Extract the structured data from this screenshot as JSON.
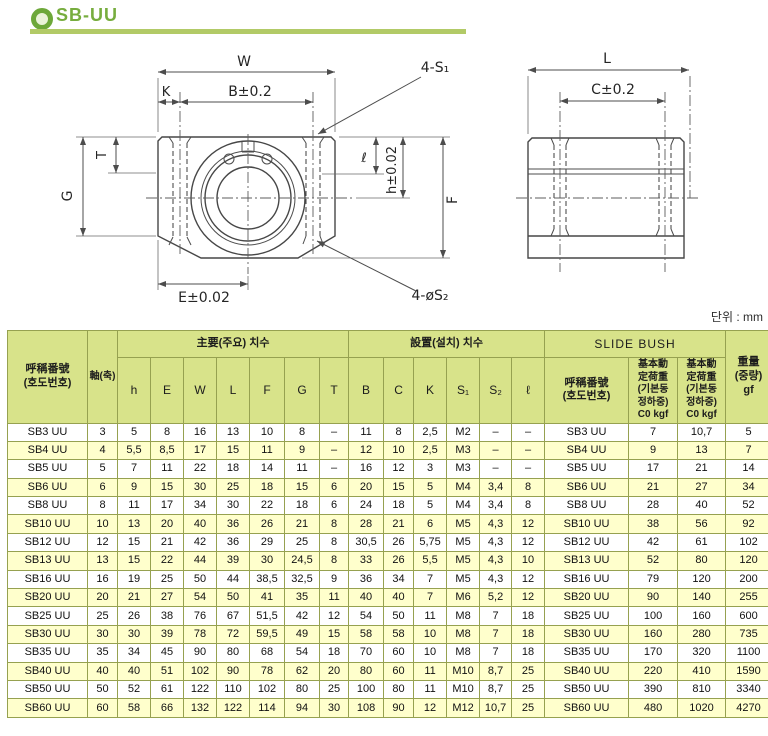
{
  "page": {
    "title": "SB-UU",
    "unit_note": "단위 : mm"
  },
  "colors": {
    "accent_green": "#77ad3e",
    "underline_green": "#b2ca67",
    "table_header_bg": "#d8e38a",
    "row_stripe": "#ffffcc",
    "grid_border": "#96a150"
  },
  "drawing": {
    "front": {
      "w": "W",
      "k": "K",
      "b": "B±0.2",
      "s1_callout": "4-S₁",
      "t": "T",
      "g": "G",
      "ell": "ℓ",
      "h": "h±0.02",
      "f": "F",
      "e": "E±0.02",
      "s2_callout": "4-øS₂"
    },
    "side": {
      "l": "L",
      "c": "C±0.2"
    }
  },
  "table": {
    "header": {
      "model": "呼稱番號\n(호도번호)",
      "shaft": "軸(축)",
      "main_dims": "主要(주요) 치수",
      "main_cols": [
        "h",
        "E",
        "W",
        "L",
        "F",
        "G",
        "T"
      ],
      "mount_dims": "設置(설치) 치수",
      "mount_cols": [
        "B",
        "C",
        "K",
        "S₁",
        "S₂",
        "ℓ"
      ],
      "slide_bush": "SLIDE BUSH",
      "bush_model": "呼稱番號\n(호도번호)",
      "load1": "基本動\n定荷重\n(기본동\n정하중)\nC0 kgf",
      "load2": "基本動\n定荷重\n(기본동\n정하중)\nC0 kgf",
      "weight": "重量\n(중량)\ngf"
    },
    "rows": [
      [
        "SB3 UU",
        "3",
        "5",
        "8",
        "16",
        "13",
        "10",
        "8",
        "–",
        "11",
        "8",
        "2,5",
        "M2",
        "–",
        "–",
        "SB3 UU",
        "7",
        "10,7",
        "5"
      ],
      [
        "SB4 UU",
        "4",
        "5,5",
        "8,5",
        "17",
        "15",
        "11",
        "9",
        "–",
        "12",
        "10",
        "2,5",
        "M3",
        "–",
        "–",
        "SB4 UU",
        "9",
        "13",
        "7"
      ],
      [
        "SB5 UU",
        "5",
        "7",
        "11",
        "22",
        "18",
        "14",
        "11",
        "–",
        "16",
        "12",
        "3",
        "M3",
        "–",
        "–",
        "SB5 UU",
        "17",
        "21",
        "14"
      ],
      [
        "SB6 UU",
        "6",
        "9",
        "15",
        "30",
        "25",
        "18",
        "15",
        "6",
        "20",
        "15",
        "5",
        "M4",
        "3,4",
        "8",
        "SB6 UU",
        "21",
        "27",
        "34"
      ],
      [
        "SB8 UU",
        "8",
        "11",
        "17",
        "34",
        "30",
        "22",
        "18",
        "6",
        "24",
        "18",
        "5",
        "M4",
        "3,4",
        "8",
        "SB8 UU",
        "28",
        "40",
        "52"
      ],
      [
        "SB10 UU",
        "10",
        "13",
        "20",
        "40",
        "36",
        "26",
        "21",
        "8",
        "28",
        "21",
        "6",
        "M5",
        "4,3",
        "12",
        "SB10 UU",
        "38",
        "56",
        "92"
      ],
      [
        "SB12 UU",
        "12",
        "15",
        "21",
        "42",
        "36",
        "29",
        "25",
        "8",
        "30,5",
        "26",
        "5,75",
        "M5",
        "4,3",
        "12",
        "SB12 UU",
        "42",
        "61",
        "102"
      ],
      [
        "SB13 UU",
        "13",
        "15",
        "22",
        "44",
        "39",
        "30",
        "24,5",
        "8",
        "33",
        "26",
        "5,5",
        "M5",
        "4,3",
        "10",
        "SB13 UU",
        "52",
        "80",
        "120"
      ],
      [
        "SB16 UU",
        "16",
        "19",
        "25",
        "50",
        "44",
        "38,5",
        "32,5",
        "9",
        "36",
        "34",
        "7",
        "M5",
        "4,3",
        "12",
        "SB16 UU",
        "79",
        "120",
        "200"
      ],
      [
        "SB20 UU",
        "20",
        "21",
        "27",
        "54",
        "50",
        "41",
        "35",
        "11",
        "40",
        "40",
        "7",
        "M6",
        "5,2",
        "12",
        "SB20 UU",
        "90",
        "140",
        "255"
      ],
      [
        "SB25 UU",
        "25",
        "26",
        "38",
        "76",
        "67",
        "51,5",
        "42",
        "12",
        "54",
        "50",
        "11",
        "M8",
        "7",
        "18",
        "SB25 UU",
        "100",
        "160",
        "600"
      ],
      [
        "SB30 UU",
        "30",
        "30",
        "39",
        "78",
        "72",
        "59,5",
        "49",
        "15",
        "58",
        "58",
        "10",
        "M8",
        "7",
        "18",
        "SB30 UU",
        "160",
        "280",
        "735"
      ],
      [
        "SB35 UU",
        "35",
        "34",
        "45",
        "90",
        "80",
        "68",
        "54",
        "18",
        "70",
        "60",
        "10",
        "M8",
        "7",
        "18",
        "SB35 UU",
        "170",
        "320",
        "1100"
      ],
      [
        "SB40 UU",
        "40",
        "40",
        "51",
        "102",
        "90",
        "78",
        "62",
        "20",
        "80",
        "60",
        "11",
        "M10",
        "8,7",
        "25",
        "SB40 UU",
        "220",
        "410",
        "1590"
      ],
      [
        "SB50 UU",
        "50",
        "52",
        "61",
        "122",
        "110",
        "102",
        "80",
        "25",
        "100",
        "80",
        "11",
        "M10",
        "8,7",
        "25",
        "SB50 UU",
        "390",
        "810",
        "3340"
      ],
      [
        "SB60 UU",
        "60",
        "58",
        "66",
        "132",
        "122",
        "114",
        "94",
        "30",
        "108",
        "90",
        "12",
        "M12",
        "10,7",
        "25",
        "SB60 UU",
        "480",
        "1020",
        "4270"
      ]
    ]
  }
}
